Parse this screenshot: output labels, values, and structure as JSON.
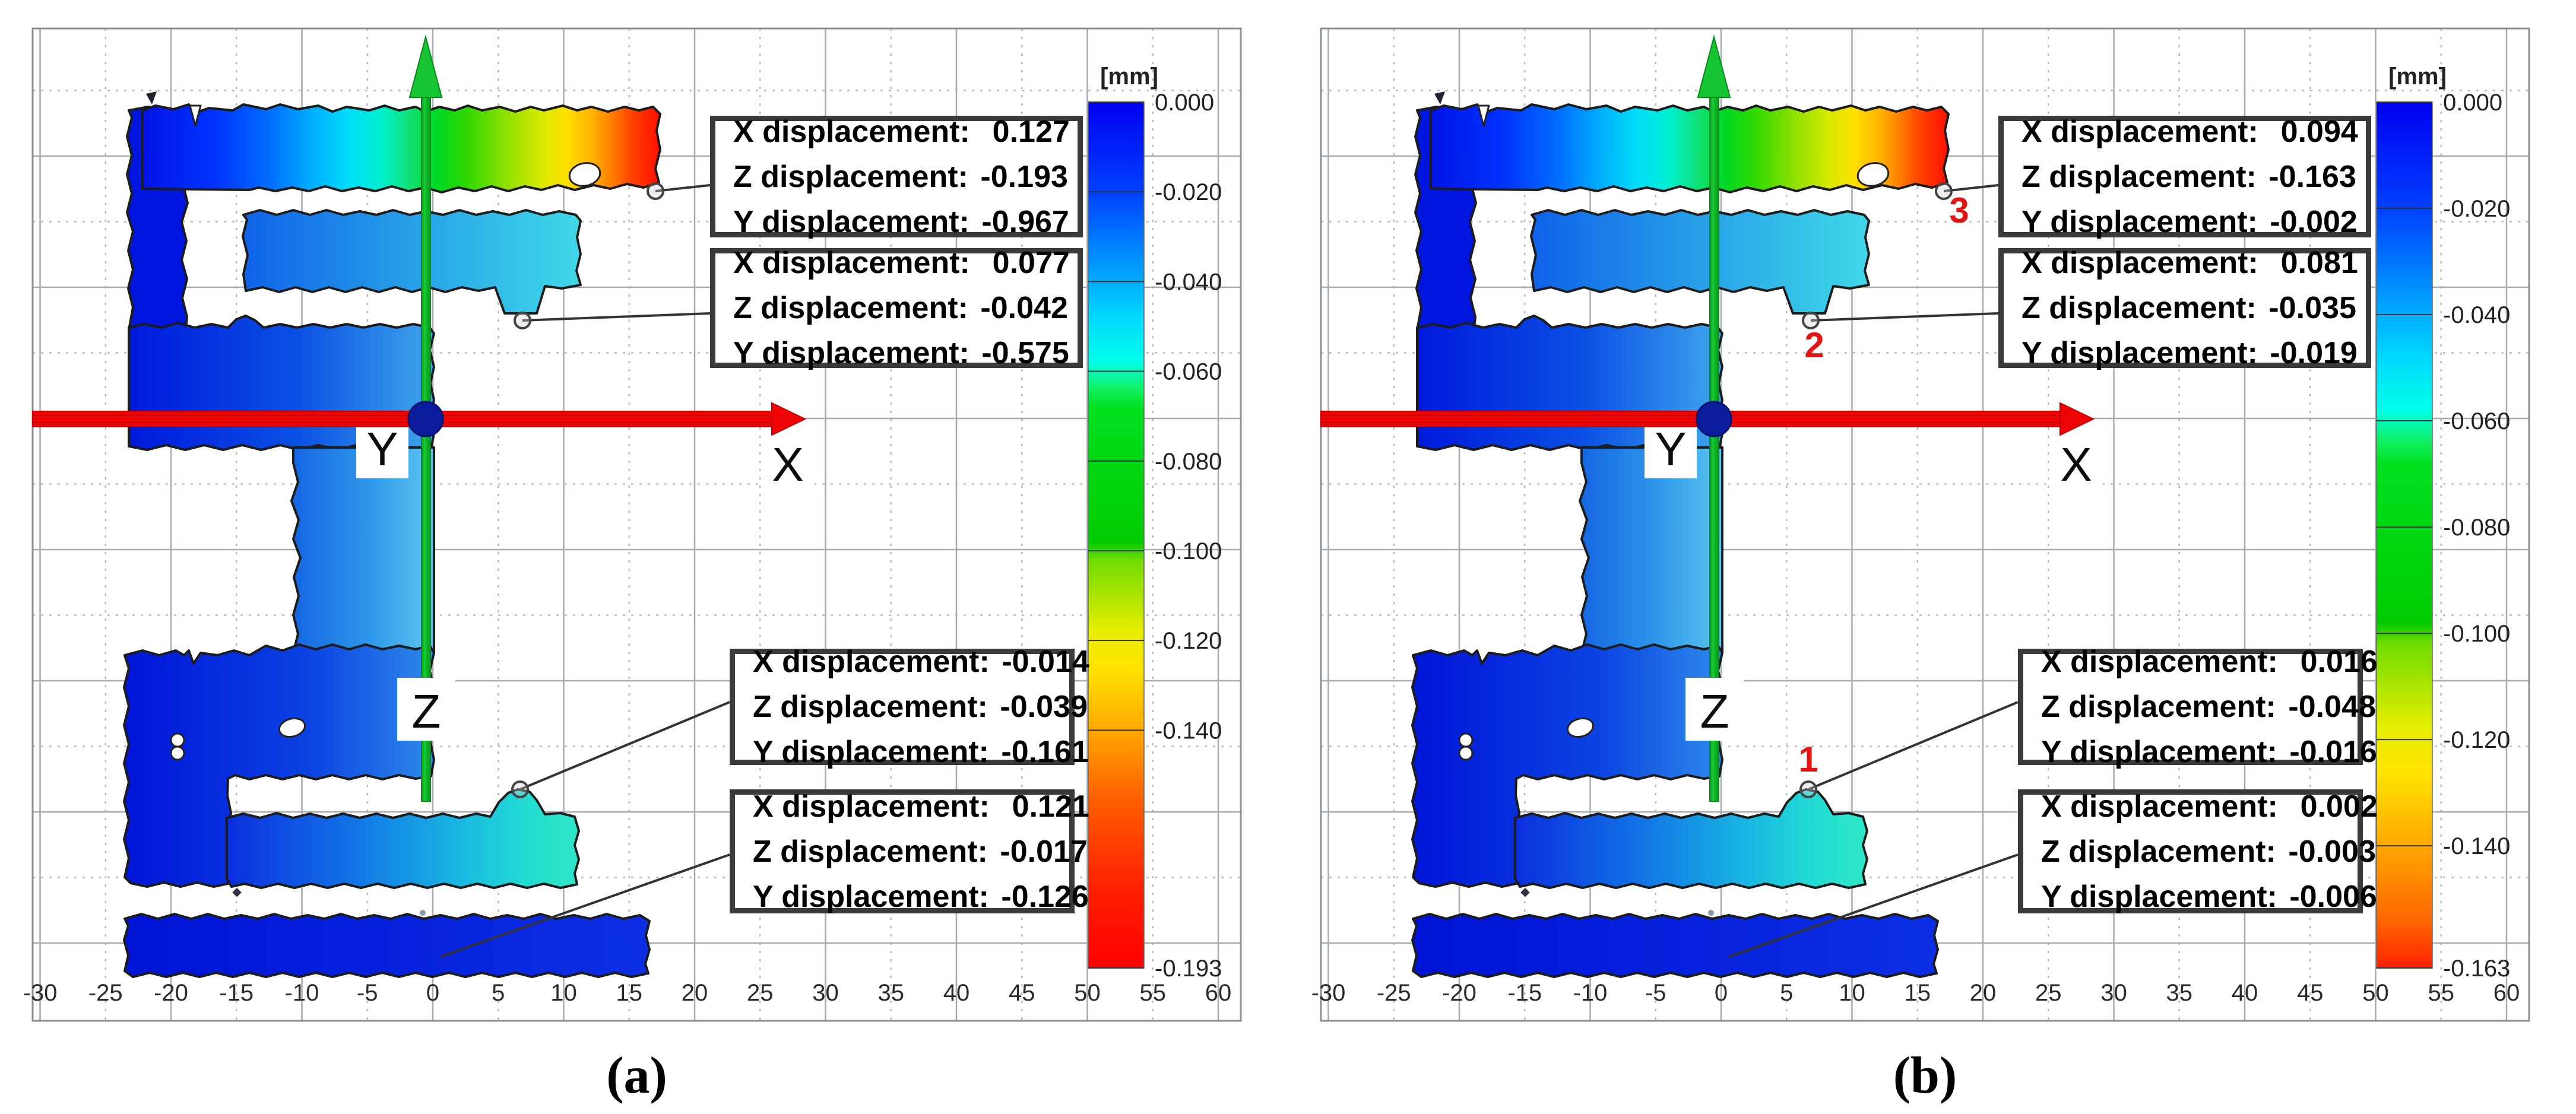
{
  "figure": {
    "axis_letters": {
      "x": "X",
      "y": "Y",
      "z": "Z"
    },
    "colorbar_title": "[mm]",
    "x_ticks": [
      "-30",
      "-25",
      "-20",
      "-15",
      "-10",
      "-5",
      "0",
      "5",
      "10",
      "15",
      "20",
      "25",
      "30",
      "35",
      "40",
      "45",
      "50",
      "55",
      "60"
    ],
    "panels": [
      {
        "id": "a",
        "caption": "(a)",
        "scale_min": -0.193,
        "colorbar_labels": [
          "0.000",
          "-0.020",
          "-0.040",
          "-0.060",
          "-0.080",
          "-0.100",
          "-0.120",
          "-0.140",
          "-0.193"
        ],
        "annotations": [
          {
            "lines": [
              {
                "label": "X displacement:",
                "value": "0.127"
              },
              {
                "label": "Z displacement:",
                "value": "-0.193"
              },
              {
                "label": "Y displacement:",
                "value": "-0.967"
              }
            ]
          },
          {
            "lines": [
              {
                "label": "X displacement:",
                "value": "0.077"
              },
              {
                "label": "Z displacement:",
                "value": "-0.042"
              },
              {
                "label": "Y displacement:",
                "value": "-0.575"
              }
            ]
          },
          {
            "lines": [
              {
                "label": "X displacement:",
                "value": "-0.014"
              },
              {
                "label": "Z displacement:",
                "value": "-0.039"
              },
              {
                "label": "Y displacement:",
                "value": "-0.161"
              }
            ]
          },
          {
            "lines": [
              {
                "label": "X displacement:",
                "value": "0.121"
              },
              {
                "label": "Z displacement:",
                "value": "-0.017"
              },
              {
                "label": "Y displacement:",
                "value": "-0.126"
              }
            ]
          }
        ],
        "point_labels": []
      },
      {
        "id": "b",
        "caption": "(b)",
        "scale_min": -0.163,
        "colorbar_labels": [
          "0.000",
          "-0.020",
          "-0.040",
          "-0.060",
          "-0.080",
          "-0.100",
          "-0.120",
          "-0.140",
          "-0.163"
        ],
        "annotations": [
          {
            "lines": [
              {
                "label": "X displacement:",
                "value": "0.094"
              },
              {
                "label": "Z displacement:",
                "value": "-0.163"
              },
              {
                "label": "Y displacement:",
                "value": "-0.002"
              }
            ]
          },
          {
            "lines": [
              {
                "label": "X displacement:",
                "value": "0.081"
              },
              {
                "label": "Z displacement:",
                "value": "-0.035"
              },
              {
                "label": "Y displacement:",
                "value": "-0.019"
              }
            ]
          },
          {
            "lines": [
              {
                "label": "X displacement:",
                "value": "0.016"
              },
              {
                "label": "Z displacement:",
                "value": "-0.048"
              },
              {
                "label": "Y displacement:",
                "value": "-0.016"
              }
            ]
          },
          {
            "lines": [
              {
                "label": "X displacement:",
                "value": "0.002"
              },
              {
                "label": "Z displacement:",
                "value": "-0.003"
              },
              {
                "label": "Y displacement:",
                "value": "-0.006"
              }
            ]
          }
        ],
        "point_labels": [
          {
            "text": "1"
          },
          {
            "text": "2"
          },
          {
            "text": "3"
          }
        ]
      }
    ]
  },
  "chart_data": [
    {
      "panel": "a",
      "type": "heatmap",
      "unit": "mm",
      "x_axis": {
        "range": [
          -30,
          60
        ],
        "tick_step": 5
      },
      "colorbar": {
        "title": "[mm]",
        "max": 0.0,
        "min": -0.193,
        "tick_labels": [
          "0.000",
          "-0.020",
          "-0.040",
          "-0.060",
          "-0.080",
          "-0.100",
          "-0.120",
          "-0.140",
          "-0.193"
        ]
      },
      "annotated_points": [
        {
          "location": "top-bar-right-end",
          "x_displacement": 0.127,
          "z_displacement": -0.193,
          "y_displacement": -0.967
        },
        {
          "location": "upper-middle-bar",
          "x_displacement": 0.077,
          "z_displacement": -0.042,
          "y_displacement": -0.575
        },
        {
          "location": "lower-bar-bump",
          "x_displacement": -0.014,
          "z_displacement": -0.039,
          "y_displacement": -0.161
        },
        {
          "location": "bottom-bar",
          "x_displacement": 0.121,
          "z_displacement": -0.017,
          "y_displacement": -0.126
        }
      ]
    },
    {
      "panel": "b",
      "type": "heatmap",
      "unit": "mm",
      "x_axis": {
        "range": [
          -30,
          60
        ],
        "tick_step": 5
      },
      "colorbar": {
        "title": "[mm]",
        "max": 0.0,
        "min": -0.163,
        "tick_labels": [
          "0.000",
          "-0.020",
          "-0.040",
          "-0.060",
          "-0.080",
          "-0.100",
          "-0.120",
          "-0.140",
          "-0.163"
        ]
      },
      "annotated_points": [
        {
          "point": "3",
          "location": "top-bar-right-end",
          "x_displacement": 0.094,
          "z_displacement": -0.163,
          "y_displacement": -0.002
        },
        {
          "point": "2",
          "location": "upper-middle-bar",
          "x_displacement": 0.081,
          "z_displacement": -0.035,
          "y_displacement": -0.019
        },
        {
          "point": "1",
          "location": "lower-bar-bump",
          "x_displacement": 0.016,
          "z_displacement": -0.048,
          "y_displacement": -0.016
        },
        {
          "point": "",
          "location": "bottom-bar",
          "x_displacement": 0.002,
          "z_displacement": -0.003,
          "y_displacement": -0.006
        }
      ]
    },
    {
      "type": "colorbar_scale_colors",
      "stops": [
        {
          "v": 0.0,
          "c": "#0000f0"
        },
        {
          "v": -0.02,
          "c": "#0040ff"
        },
        {
          "v": -0.035,
          "c": "#0090ff"
        },
        {
          "v": -0.048,
          "c": "#00d8ff"
        },
        {
          "v": -0.058,
          "c": "#00ffe8"
        },
        {
          "v": -0.064,
          "c": "#10f060"
        },
        {
          "v": -0.068,
          "c": "#00e020"
        },
        {
          "v": -0.098,
          "c": "#00cc00"
        },
        {
          "v": -0.102,
          "c": "#70dc00"
        },
        {
          "v": -0.118,
          "c": "#e8ee00"
        },
        {
          "v": -0.126,
          "c": "#ffe400"
        },
        {
          "v": -0.14,
          "c": "#ffa800"
        },
        {
          "v": -0.155,
          "c": "#ff6000"
        },
        {
          "v": -0.175,
          "c": "#ff2000"
        },
        {
          "v": -0.193,
          "c": "#ff0000"
        }
      ]
    }
  ]
}
